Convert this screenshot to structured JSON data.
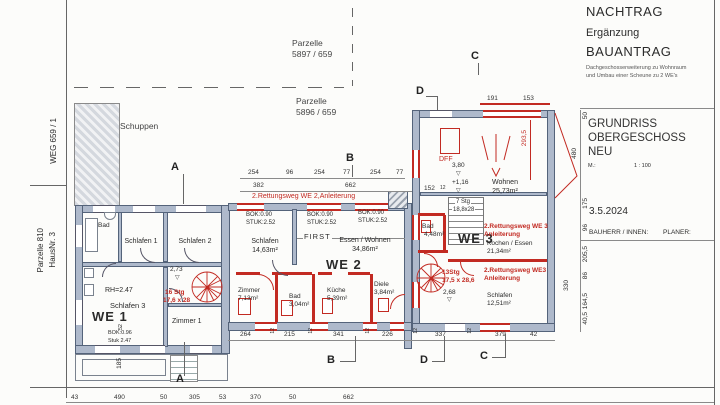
{
  "header": {
    "nachtrag": "NACHTRAG",
    "ergaenzung": "Ergänzung",
    "bauantrag": "BAUANTRAG",
    "note_line1": "Dachgeschosserweiterung zu Wohnraum",
    "note_line2": "und Umbau einer Scheune zu 2 WE's"
  },
  "title_block": {
    "line1": "GRUNDRISS",
    "line2": "OBERGESCHOSS",
    "line3": "NEU",
    "scale_label": "M.:",
    "scale_value": "1 : 100",
    "date": "3.5.2024",
    "bauherr": "BAUHERR / INNEN:",
    "planer": "PLANER:"
  },
  "site": {
    "weg": "WEG 659 / 1",
    "parzelle_left_line1": "Parzelle 810",
    "parzelle_left_line2": "HausNr. 3",
    "parzelle_top_line1": "Parzelle",
    "parzelle_top_line2": "5897 / 659",
    "parzelle_mid_line1": "Parzelle",
    "parzelle_mid_line2": "5896 / 659",
    "schuppen": "Schuppen"
  },
  "we1": {
    "label": "WE 1",
    "bad": "Bad",
    "schlafen1": "Schlafen 1",
    "schlafen2": "Schlafen 2",
    "schlafen3": "Schlafen 3",
    "zimmer1": "Zimmer 1",
    "rh": "RH=2.47",
    "bok": "BOK:0.96",
    "stuk": "Stuk 2.47",
    "stair_line1": "16 Stg",
    "stair_line2": "17,6 x 28",
    "dim_273": "2,73"
  },
  "we2": {
    "label": "WE 2",
    "rettungsweg": "2.Rettungsweg WE 2,Anleiterung",
    "bok": "BOK:0.90",
    "stuk": "STUK:2.52",
    "first": "FIRST",
    "schlafen": "Schlafen",
    "schlafen_area": "14,63m²",
    "essen_wohnen": "Essen / Wohnen",
    "essen_wohnen_area": "34,86m²",
    "zimmer": "Zimmer",
    "zimmer_area": "7,13m²",
    "bad": "Bad",
    "bad_area": "3,04m²",
    "kueche": "Küche",
    "kueche_area": "5,39m²",
    "diele": "Diele",
    "diele_area": "3,84m²"
  },
  "we3": {
    "label": "WE 3",
    "dff": "DFF",
    "wohnen": "Wohnen",
    "wohnen_area": "25,73m²",
    "level_380": "3,80",
    "level_116": "+1,16",
    "level_268": "2,68",
    "stair_line1": "7 Stg",
    "stair_line2": "18,8x28",
    "spiral_line1": "13Stg",
    "spiral_line2": "17,5 x 28,6",
    "bad": "Bad",
    "bad_area": "4,48m²",
    "rettungsweg1_line1": "2.Rettungsweg WE 3",
    "rettungsweg1_line2": "Anleiterung",
    "kochen_essen": "Kochen / Essen",
    "kochen_essen_area": "21,34m²",
    "rettungsweg2_line1": "2.Rettungsweg WE3",
    "rettungsweg2_line2": "Anleiterung",
    "schlafen": "Schlafen",
    "schlafen_area": "12,51m²"
  },
  "markers": {
    "a": "A",
    "b": "B",
    "c": "C",
    "d": "D"
  },
  "dims": {
    "top_row": [
      "254",
      "96",
      "254",
      "77",
      "254",
      "77"
    ],
    "mid_row": [
      "382",
      "662"
    ],
    "we3_top": [
      "191",
      "153"
    ],
    "right_col": [
      "50",
      "175",
      "96",
      "205,5",
      "86",
      "164,5",
      "40,5"
    ],
    "col_480": "480",
    "col_330": "330",
    "red_2935": "293,5",
    "dim_152": "152",
    "sep": "12",
    "inner_bottom": [
      "264",
      "215",
      "341",
      "226",
      "337",
      "379",
      "42"
    ],
    "outer_bottom": [
      "43",
      "490",
      "50",
      "305",
      "53",
      "370",
      "50",
      "662"
    ],
    "left_52": "52",
    "left_185": "185"
  },
  "icons": {
    "level_symbol": "▽"
  },
  "colors": {
    "wall": "#aeb9cb",
    "wall_edge": "#54637a",
    "red": "#c22a22",
    "ink": "#2b2b2b"
  }
}
